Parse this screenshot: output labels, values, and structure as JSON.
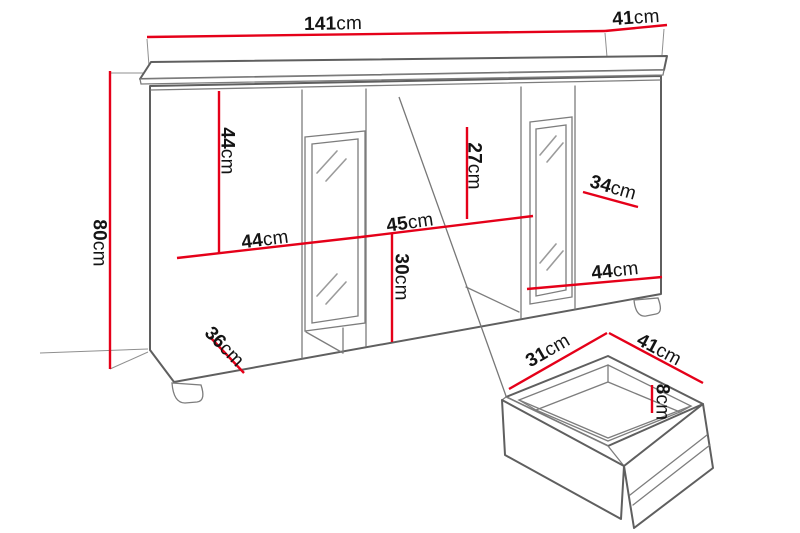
{
  "unit": "cm",
  "cabinet": {
    "width": "141",
    "depth": "41",
    "height": "80",
    "left_door_height": "44",
    "left_compartment_width": "44",
    "upper_shelf_height": "27",
    "center_compartment_width": "45",
    "lower_compartment_height": "30",
    "right_shelf_depth": "34",
    "right_compartment_width": "44",
    "plinth_depth": "36"
  },
  "drawer": {
    "depth": "31",
    "width": "41",
    "height": "8"
  },
  "colors": {
    "dimension_red": "#e50019",
    "outline_gray": "#5f5f5f",
    "hidden_gray": "#a5a5a5",
    "label_black": "#141414"
  }
}
